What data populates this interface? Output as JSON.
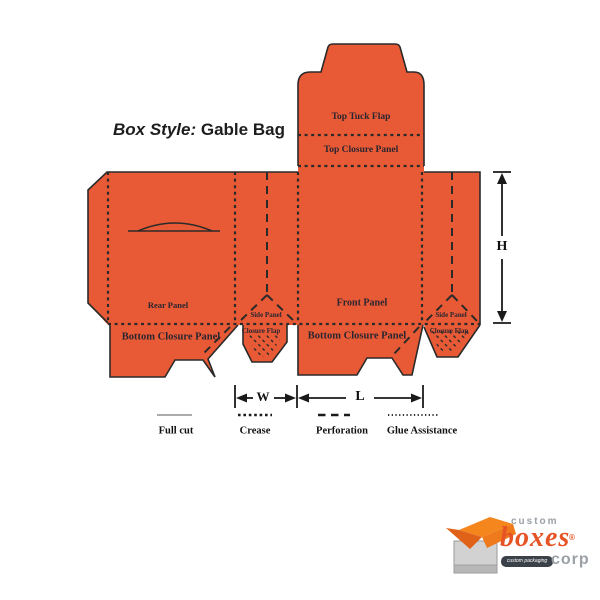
{
  "title": {
    "prefix": "Box Style:",
    "name": "Gable Bag"
  },
  "panels": {
    "top_tuck_flap": "Top Tuck Flap",
    "top_closure_panel": "Top Closure Panel",
    "rear_panel": "Rear Panel",
    "front_panel": "Front Panel",
    "side_panel_left": "Side Panel",
    "side_panel_right": "Side Panel",
    "closure_flap_left": "Closure Flap",
    "closure_flap_right": "Closure Flap",
    "bottom_closure_panel_left": "Bottom Closure Panel",
    "bottom_closure_panel_right": "Bottom Closure Panel"
  },
  "dimensions": {
    "height": "H",
    "width": "W",
    "length": "L"
  },
  "legend": [
    {
      "label": "Full cut",
      "style": "solid"
    },
    {
      "label": "Crease",
      "style": "square-dotted"
    },
    {
      "label": "Perforation",
      "style": "long-dashed"
    },
    {
      "label": "Glue Assistance",
      "style": "fine-dotted"
    }
  ],
  "logo": {
    "word_custom": "custom",
    "word_boxes": "boxes",
    "word_corp": "corp",
    "registered": "®",
    "tagline": "custom packaging solutions"
  },
  "colors": {
    "dieline_fill": "#e85a35",
    "dieline_line": "#2a2a2a",
    "logo_orange": "#e65426",
    "logo_lid_orange": "#f5861e",
    "logo_gray": "#9aa0a6",
    "logo_banner": "#3b4148"
  }
}
